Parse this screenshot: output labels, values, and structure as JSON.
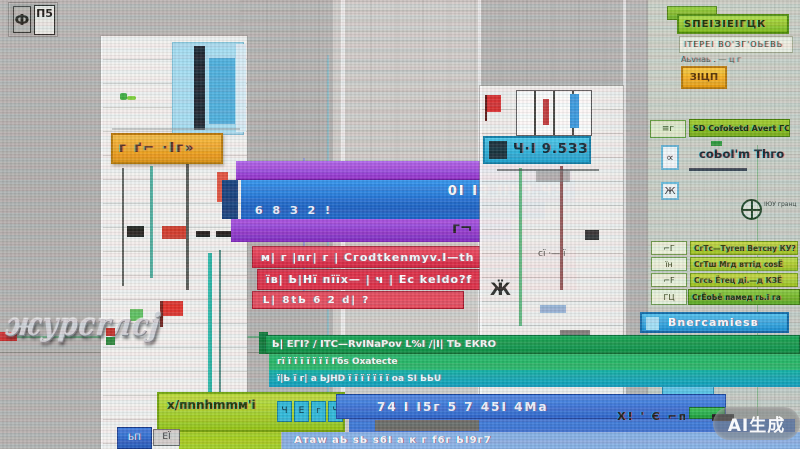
{
  "watermark": {
    "label": "AI生成"
  },
  "logo": {
    "left_glyph": "Ф",
    "right_glyph": "П5"
  },
  "side_text": {
    "label": "жypcrлcj"
  },
  "left_tower": {
    "orange_bar_text": "г ґ⌐ ·Іг»",
    "lime_bar_text": "х/пnnhmmм'і",
    "lime_chips": [
      "Ч",
      "Е",
      "г",
      "Ч"
    ],
    "gray_chip_text": "ЕЇ",
    "blue_chip_text": "ЬП"
  },
  "center": {
    "blue_main_text": "0І ІЗ ІІЧЗ.ЧЗ",
    "blue_sub_text": "6 8 З 2 !",
    "red_rows": [
      "м| г |пг| г |   Сгоdtkеnmуv.І—th",
      "їв| Ь|Нї пїїх— | ч |  Ес kеІdо?f",
      "L| 8tЬ 6 2 d| ?"
    ],
    "bracket_text": "г¬",
    "green_rows": [
      "Ь| ЕГІ? /  ІТС—RvІNаРоv        L%І  /|І|     ТЬ ЕКRО",
      "гї  ї ї ї ї ї ї ї        Гбѕ Охаtесtе",
      "ї|Ь ї г| а    ЬЈНD  ї ї ї ї        ї ї ї   оа ЅІ ЬЬU"
    ],
    "bottom_blue_text": "74 І І5г 5 7 45І 4Ма",
    "bottom_strip_text": "Атаw аЬ ѕЬ ѕ6І а к г f6г ЬІ9г7"
  },
  "mid_tower": {
    "header_text": "Ч·І 9.5ЗЗ",
    "spider_glyph": "Ӝ",
    "row_glyph": "сї ·— ї"
  },
  "right_panel": {
    "green_button_text": "ЅПЕІЗІЕІГЦК",
    "light_strip_text": "ІТЕРЕІ ВО'ЗГ'ОЬЕВЬ",
    "gray_text": "Аьvнаь .  —  ц г",
    "orange_button_text": "ЗІЦП",
    "green_bar_icon": "≡г",
    "green_bar_text": "ЅD Соfоkеtd Аvеrt ГС",
    "cell_glyph_1": "∝",
    "column_label": "соЬоІ'm Тhго",
    "cell_glyph_2": "Ж",
    "globe_text": "ІЮУ гранц",
    "list_rows": [
      {
        "icon": "⌐Г",
        "label": "СгТс—Тугеп Ветсну КУ?"
      },
      {
        "icon": "їн",
        "label": "СгТш Мгд вттід соѕЁ"
      },
      {
        "icon": "⌐F",
        "label": "Сгсь Ётец ді.—д КЗЁ"
      },
      {
        "icon": "ГЦ",
        "label": "СгЁоЬё памед гь.ї га"
      }
    ],
    "blue_header_text": "Вnегсаmіеѕв",
    "handle_glyph": "⌐f",
    "right_glyph": "г",
    "mini_buttons": [
      "Росв—ш",
      "пго",
      "ЅЦІГАЬ ЈА"
    ],
    "value_left": "па",
    "value_right": "го/t",
    "bottom_icons_text": "X! ' Є ⌐п"
  }
}
